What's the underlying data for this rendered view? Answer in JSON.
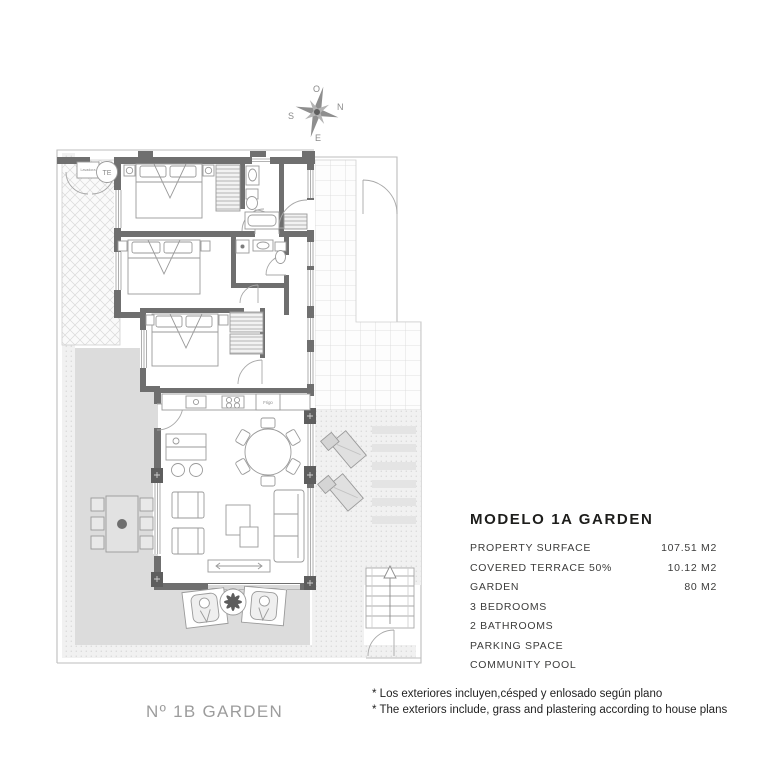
{
  "colors": {
    "wall": "#6f6f6f",
    "garden": "#dcdcdc",
    "furniture_line": "#9a9a9a",
    "title_text": "#1d1d1b",
    "spec_text": "#3c3c3b",
    "muted_label": "#9c9c9c"
  },
  "compass": {
    "top": "O",
    "right": "N",
    "left": "S",
    "bottom": "E"
  },
  "plan_labels": {
    "water_heater": "TE",
    "washer": "Lavadora",
    "fridge": "Frigo"
  },
  "specs": {
    "title": "MODELO 1A GARDEN",
    "rows": [
      {
        "label": "PROPERTY SURFACE",
        "value": "107.51 M2"
      },
      {
        "label": "COVERED TERRACE  50%",
        "value": "10.12 M2"
      },
      {
        "label": "GARDEN",
        "value": "80 M2"
      },
      {
        "label": "3 BEDROOMS",
        "value": ""
      },
      {
        "label": "2 BATHROOMS",
        "value": ""
      },
      {
        "label": "PARKING SPACE",
        "value": ""
      },
      {
        "label": "COMMUNITY POOL",
        "value": ""
      }
    ]
  },
  "footer": {
    "unit_label": "Nº 1B GARDEN",
    "notes": [
      "* Los exteriores incluyen,césped y enlosado según plano",
      "* The exteriors include, grass and plastering according to house plans"
    ]
  }
}
